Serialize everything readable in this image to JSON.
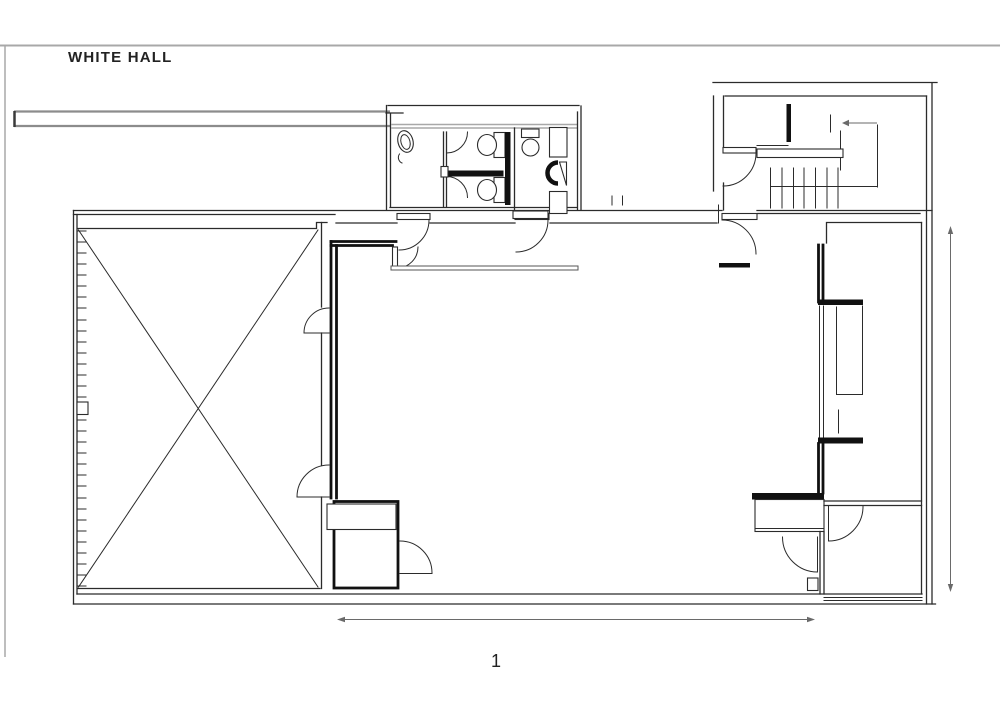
{
  "page": {
    "title": "WHITE HALL",
    "sheet_number": "1"
  },
  "colors": {
    "background": "#ffffff",
    "ink": "#222222",
    "wall_heavy": "#111111",
    "line": "#2b2b2b",
    "gray_rule": "#a8a8a8",
    "bar_gray": "#8c8c8c",
    "dim": "#6a6a6a"
  },
  "plan": {
    "fixture_icons": [
      "x-braced-area-cross",
      "swing-door-arc",
      "sink-oval-icon",
      "toilet-icon",
      "toilet-icon",
      "wc-basin-icon",
      "urinal-icon",
      "cabinet-icon",
      "cabinet-icon",
      "staircase-treads-icon",
      "direction-arrow-icon",
      "vertical-dimension-arrow",
      "horizontal-dimension-line"
    ]
  }
}
